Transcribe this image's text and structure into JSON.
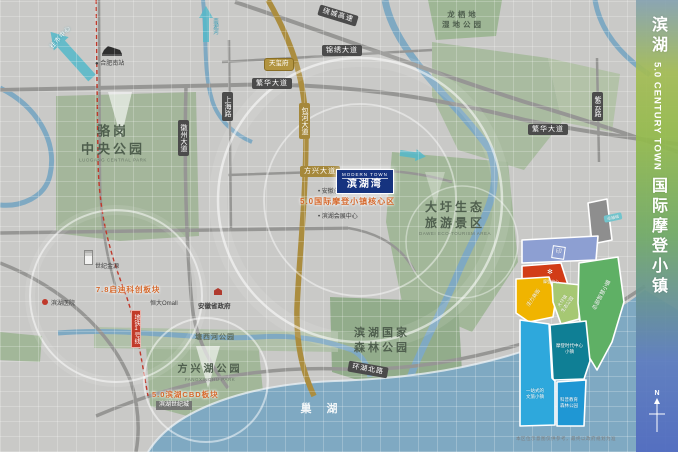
{
  "sidebar": {
    "line1": "滨湖",
    "line2": "5.0 CENTURY TOWN",
    "line3": "国际摩登小镇",
    "compass": "N"
  },
  "project": {
    "logo_en": "MODERN TOWN",
    "logo_cn": "滨湖湾",
    "core_plate": "5.0国际摩登小镇核心区"
  },
  "plates": {
    "qidi": "7.8启迪科创板块",
    "cbd": "5.0滨湖CBD板块"
  },
  "parks": {
    "luogang": {
      "l1": "骆岗",
      "l2": "中央公园",
      "en": "LUOGANG CENTRAL PARK"
    },
    "dawei": {
      "l1": "大圩生态",
      "l2": "旅游景区",
      "en": "DAWEI ECO-TOURISM AREA"
    },
    "forest": {
      "l1": "滨湖国家",
      "l2": "森林公园"
    },
    "fangxing": {
      "name": "方兴湖公园",
      "en": "FANGXINGHU PARK"
    },
    "tangxi": {
      "name": "塘西河公园"
    },
    "longqidi": {
      "l1": "龙栖地",
      "l2": "湿地公园"
    }
  },
  "water": {
    "chaohu": "巢 湖",
    "nanfei": "南淝河"
  },
  "roads": {
    "raocheng": "绕城高速",
    "jinxiu": "锦绣大道",
    "fanhua_w": "繁华大道",
    "fanhua_e": "繁华大道",
    "shanghai": "上海路",
    "huizhou": "徽州大道",
    "baohe": "包河大道",
    "fangxing": "方兴大道",
    "huanhu": "环湖北路",
    "ziyun": "紫云路"
  },
  "metro": {
    "line1_tag": "地铁1号线"
  },
  "pois": {
    "south_station": "合肥南站",
    "jinyuan": "世纪金源",
    "hospital": "滨湖医院",
    "hengda": "恒大Omall",
    "gov": "安徽省政府",
    "century_city": "滨湖世纪城",
    "innovation": "安徽创新馆",
    "expo": "滨湖会展中心",
    "tianxi": "天玺府"
  },
  "arrows": {
    "to_city": "往市中心"
  },
  "inset": {
    "tag": "卓越城",
    "red_name": "摩登中心",
    "yellow_name": "活力商街",
    "lgreen_l1": "大圩镇",
    "lgreen_l2": "生态公园",
    "green_name": "总部智慧小镇",
    "teal_l1": "摩登时代中心",
    "teal_l2": "小镇",
    "azure_l1": "一站式的",
    "azure_l2": "文旅小镇",
    "blue_l1": "科普教育",
    "blue_l2": "森林公园",
    "seal_glyph": "印"
  },
  "footer": {
    "disclaimer": "本区位示意图仅供参考，最终以政府规划为准"
  },
  "colors": {
    "brand_blue": "#16337f",
    "plate_orange": "#d4672a",
    "metro_red": "#c23b2a",
    "road_gold": "#a5883b",
    "lake": "#7fa9c2",
    "sidebar_green": "#94ba4c",
    "sidebar_blue": "#526cc0"
  }
}
